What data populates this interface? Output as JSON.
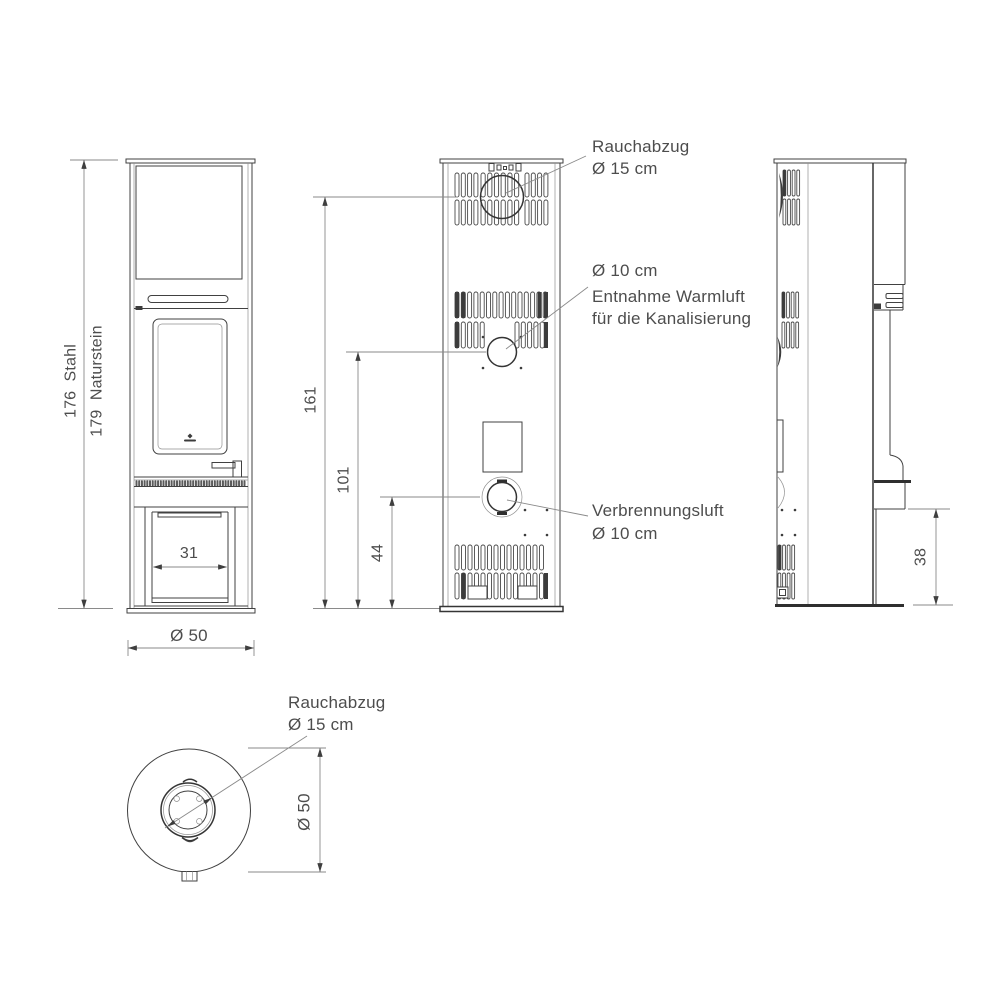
{
  "colors": {
    "background": "#ffffff",
    "line": "#414141",
    "dimension_line": "#8a8a8a",
    "text": "#4d4d4d"
  },
  "front_view": {
    "height_steel": "176  Stahl",
    "height_stone": "179  Naturstein",
    "opening_width": "31",
    "base_diameter": "Ø 50"
  },
  "rear_view": {
    "flue_height": "161",
    "warm_air_height": "101",
    "combustion_air_height": "44",
    "flue_callout": {
      "line1": "Rauchabzug",
      "line2": "Ø 15 cm"
    },
    "warm_air_callout": {
      "line1": "Ø 10 cm",
      "line2": "Entnahme Warmluft",
      "line3": "für die Kanalisierung"
    },
    "combustion_callout": {
      "line1": "Verbrennungsluft",
      "line2": "Ø 10 cm"
    }
  },
  "side_view": {
    "plinth_height": "38"
  },
  "top_view": {
    "flue_callout": {
      "line1": "Rauchabzug",
      "line2": "Ø 15 cm"
    },
    "diameter": "Ø 50"
  }
}
